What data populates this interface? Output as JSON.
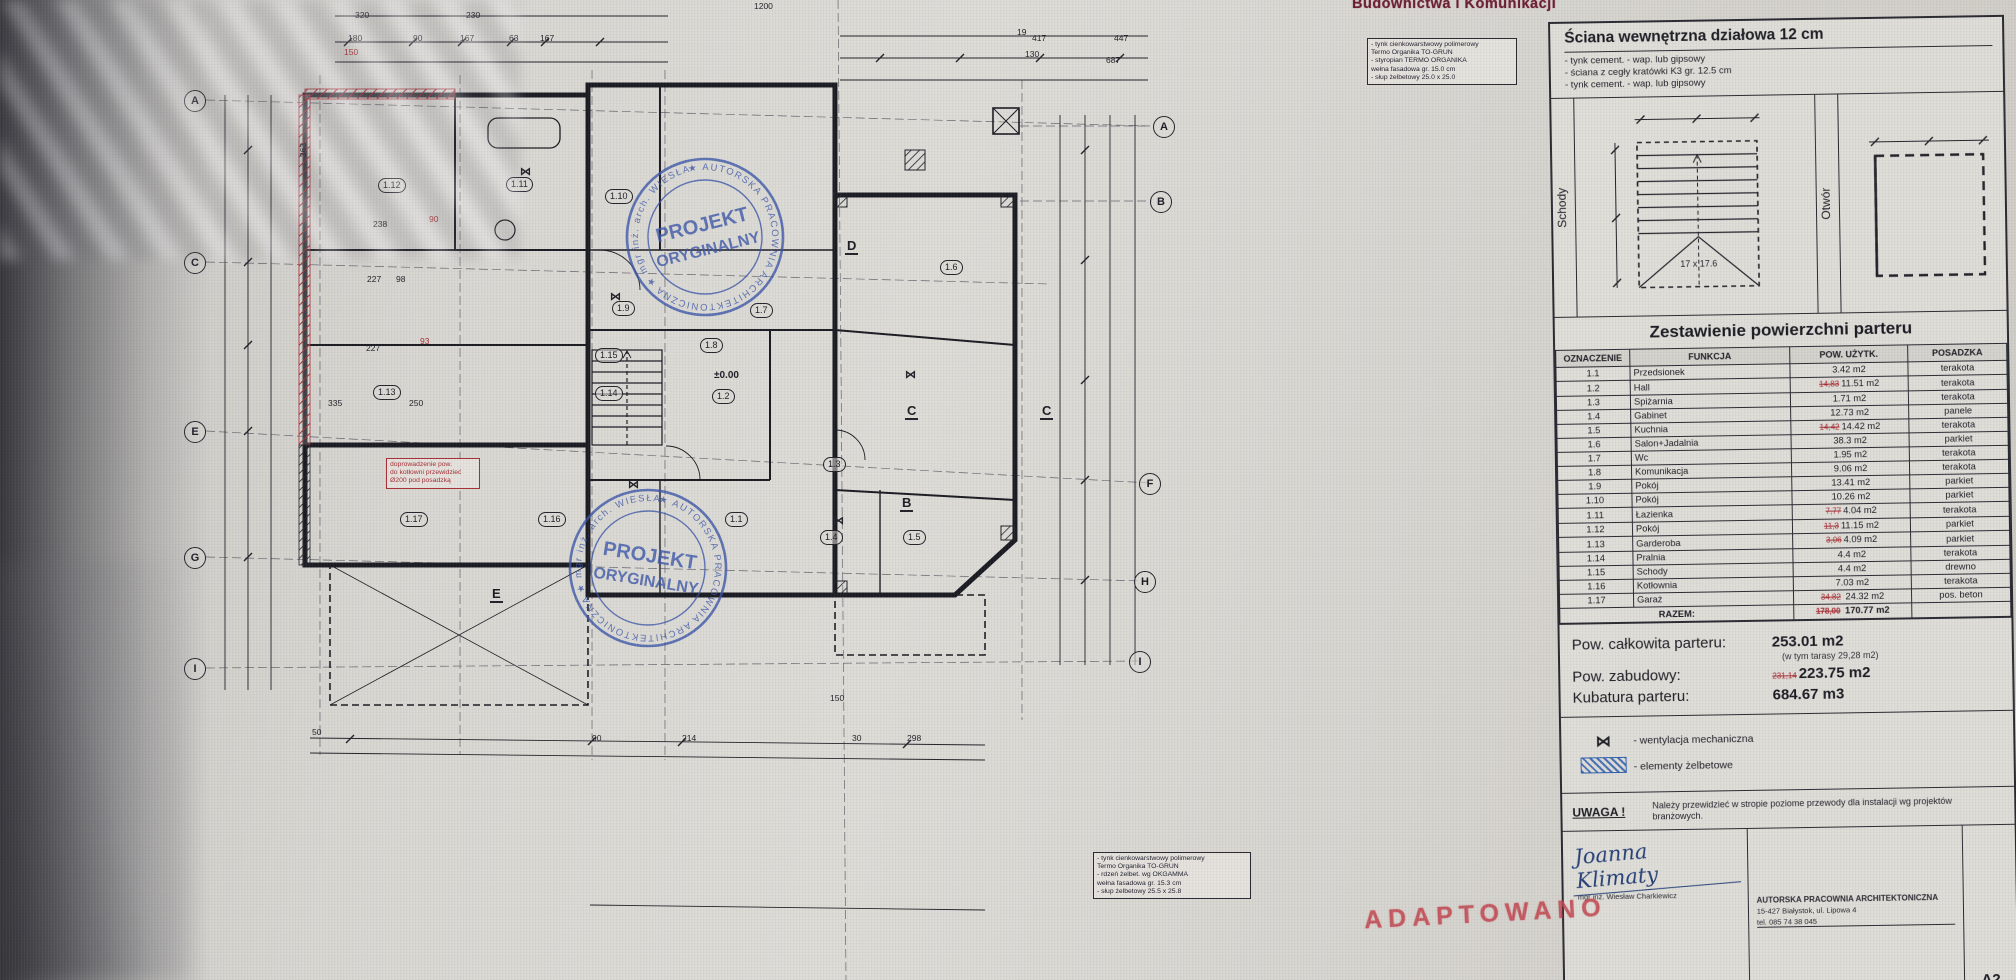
{
  "header_stamp": "Budownictwa i Komunikacji",
  "adaptowano": "ADAPTOWANO",
  "wall_spec": {
    "title": "Ściana wewnętrzna działowa 12 cm",
    "items": [
      "- tynk cement. - wap.  lub gipsowy",
      "- ściana z cegły kratówki K3 gr. 12.5 cm",
      "- tynk cement. - wap.  lub gipsowy"
    ]
  },
  "details": {
    "schody": "Schody",
    "otwor": "Otwór",
    "stairs_note": "17 x 17.6"
  },
  "area_table": {
    "title": "Zestawienie powierzchni parteru",
    "columns": [
      "OZNACZENIE",
      "FUNKCJA",
      "POW. UŻYTK.",
      "POSADZKA"
    ],
    "rows": [
      {
        "ozn": "1.1",
        "funkcja": "Przedsionek",
        "pow": "3.42 m2",
        "posadzka": "terakota"
      },
      {
        "ozn": "1.2",
        "funkcja": "Hall",
        "pow_old": "14,83",
        "pow": "11.51 m2",
        "posadzka": "terakota"
      },
      {
        "ozn": "1.3",
        "funkcja": "Spiżarnia",
        "pow": "1.71 m2",
        "posadzka": "terakota"
      },
      {
        "ozn": "1.4",
        "funkcja": "Gabinet",
        "pow": "12.73 m2",
        "posadzka": "panele"
      },
      {
        "ozn": "1.5",
        "funkcja": "Kuchnia",
        "pow_old": "14,42",
        "pow": "14.42 m2",
        "posadzka": "terakota"
      },
      {
        "ozn": "1.6",
        "funkcja": "Salon+Jadalnia",
        "pow": "38.3 m2",
        "posadzka": "parkiet"
      },
      {
        "ozn": "1.7",
        "funkcja": "Wc",
        "pow": "1.95 m2",
        "posadzka": "terakota"
      },
      {
        "ozn": "1.8",
        "funkcja": "Komunikacja",
        "pow": "9.06 m2",
        "posadzka": "terakota"
      },
      {
        "ozn": "1.9",
        "funkcja": "Pokój",
        "pow": "13.41 m2",
        "posadzka": "parkiet"
      },
      {
        "ozn": "1.10",
        "funkcja": "Pokój",
        "pow": "10.26 m2",
        "posadzka": "parkiet"
      },
      {
        "ozn": "1.11",
        "funkcja": "Łazienka",
        "pow_old": "7,77",
        "pow": "4.04 m2",
        "posadzka": "terakota"
      },
      {
        "ozn": "1.12",
        "funkcja": "Pokój",
        "pow_old": "11,3",
        "pow": "11.15 m2",
        "posadzka": "parkiet"
      },
      {
        "ozn": "1.13",
        "funkcja": "Garderoba",
        "pow_old": "3,06",
        "pow": "4.09 m2",
        "posadzka": "parkiet"
      },
      {
        "ozn": "1.14",
        "funkcja": "Pralnia",
        "pow": "4.4 m2",
        "posadzka": "terakota"
      },
      {
        "ozn": "1.15",
        "funkcja": "Schody",
        "pow": "4.4 m2",
        "posadzka": "drewno"
      },
      {
        "ozn": "1.16",
        "funkcja": "Kotłownia",
        "pow": "7.03 m2",
        "posadzka": "terakota"
      }
    ],
    "garage": {
      "ozn": "1.17",
      "funkcja": "Garaż",
      "pow_old": "34,82",
      "pow": "24.32 m2",
      "posadzka": "pos. beton"
    },
    "razem": {
      "label": "RAZEM:",
      "old": "178,00",
      "value": "170.77 m2"
    }
  },
  "totals": {
    "t1": {
      "label": "Pow. całkowita parteru:",
      "value": "253.01 m2",
      "note": "(w tym tarasy 29,28 m2)"
    },
    "t2": {
      "label": "Pow. zabudowy:",
      "old": "231,14",
      "value": "223.75 m2"
    },
    "t3": {
      "label": "Kubatura parteru:",
      "value": "684.67 m3"
    }
  },
  "legend": {
    "vent_symbol": "⋈",
    "vent_label": "- wentylacja mechaniczna",
    "rc_label": "- elementy żelbetowe"
  },
  "uwaga": {
    "label": "UWAGA !",
    "text": "Należy przewidzieć w stropie poziome przewody dla instalacji wg projektów branżowych."
  },
  "titleblock": {
    "signature": "Joanna Klimaty",
    "signature_sub": "mgr inż. Wiesław Charkiewicz",
    "firm1": "AUTORSKA PRACOWNIA ARCHITEKTONICZNA",
    "firm2": "15-427 Białystok, ul. Lipowa 4",
    "firm3": "tel. 085 74 38 045",
    "sheet": "A2"
  },
  "stamps": {
    "ring": "★ AUTORSKA PRACOWNIA ARCHITEKTONICZNA ★ mgr inż. arch. WIESŁAW CHARKIEWICZ",
    "line1": "PROJEKT",
    "line2": "ORYGINALNY"
  },
  "plan": {
    "level_mark": "±0.00",
    "labels": [
      {
        "kind": "axis",
        "t": "A",
        "x": 184,
        "y": 90
      },
      {
        "kind": "axis",
        "t": "C",
        "x": 184,
        "y": 252
      },
      {
        "kind": "axis",
        "t": "E",
        "x": 184,
        "y": 421
      },
      {
        "kind": "axis",
        "t": "G",
        "x": 184,
        "y": 547
      },
      {
        "kind": "axis",
        "t": "I",
        "x": 184,
        "y": 658
      },
      {
        "kind": "axis",
        "t": "A",
        "x": 1153,
        "y": 116
      },
      {
        "kind": "axis",
        "t": "B",
        "x": 1150,
        "y": 191
      },
      {
        "kind": "axis",
        "t": "F",
        "x": 1139,
        "y": 473
      },
      {
        "kind": "axis",
        "t": "H",
        "x": 1134,
        "y": 571
      },
      {
        "kind": "axis",
        "t": "I",
        "x": 1129,
        "y": 651
      },
      {
        "kind": "room",
        "t": "1.12",
        "x": 378,
        "y": 178
      },
      {
        "kind": "room",
        "t": "1.11",
        "x": 506,
        "y": 177
      },
      {
        "kind": "room",
        "t": "1.10",
        "x": 605,
        "y": 189
      },
      {
        "kind": "room",
        "t": "1.9",
        "x": 612,
        "y": 301
      },
      {
        "kind": "room",
        "t": "1.6",
        "x": 940,
        "y": 260
      },
      {
        "kind": "room",
        "t": "1.7",
        "x": 750,
        "y": 303
      },
      {
        "kind": "room",
        "t": "1.8",
        "x": 700,
        "y": 338
      },
      {
        "kind": "room",
        "t": "1.15",
        "x": 595,
        "y": 348
      },
      {
        "kind": "room",
        "t": "1.14",
        "x": 595,
        "y": 386
      },
      {
        "kind": "room",
        "t": "1.13",
        "x": 373,
        "y": 385
      },
      {
        "kind": "room",
        "t": "1.2",
        "x": 712,
        "y": 389
      },
      {
        "kind": "room",
        "t": "1.3",
        "x": 823,
        "y": 457
      },
      {
        "kind": "room",
        "t": "1.17",
        "x": 400,
        "y": 512
      },
      {
        "kind": "room",
        "t": "1.16",
        "x": 538,
        "y": 512
      },
      {
        "kind": "room",
        "t": "1.1",
        "x": 725,
        "y": 512
      },
      {
        "kind": "room",
        "t": "1.4",
        "x": 820,
        "y": 530
      },
      {
        "kind": "room",
        "t": "1.5",
        "x": 903,
        "y": 530
      },
      {
        "kind": "vent",
        "t": "⋈",
        "x": 520,
        "y": 165
      },
      {
        "kind": "vent",
        "t": "⋈",
        "x": 610,
        "y": 290
      },
      {
        "kind": "vent",
        "t": "⋈",
        "x": 905,
        "y": 368
      },
      {
        "kind": "vent",
        "t": "⋈",
        "x": 833,
        "y": 514
      },
      {
        "kind": "vent",
        "t": "⋈",
        "x": 628,
        "y": 478
      },
      {
        "kind": "level",
        "t": "±0.00",
        "x": 714,
        "y": 370
      },
      {
        "kind": "sect",
        "t": "D",
        "x": 845,
        "y": 238
      },
      {
        "kind": "sect",
        "t": "C",
        "x": 905,
        "y": 403
      },
      {
        "kind": "sect",
        "t": "C",
        "x": 1040,
        "y": 403
      },
      {
        "kind": "sect",
        "t": "B",
        "x": 900,
        "y": 495
      },
      {
        "kind": "sect",
        "t": "E",
        "x": 490,
        "y": 586
      },
      {
        "kind": "dim",
        "t": "320",
        "x": 355,
        "y": 10
      },
      {
        "kind": "dim",
        "t": "230",
        "x": 466,
        "y": 10
      },
      {
        "kind": "dim",
        "t": "1200",
        "x": 754,
        "y": 1
      },
      {
        "kind": "dim",
        "t": "180",
        "x": 348,
        "y": 33
      },
      {
        "kind": "dim",
        "t": "90",
        "x": 413,
        "y": 33
      },
      {
        "kind": "dim",
        "t": "167",
        "x": 460,
        "y": 33
      },
      {
        "kind": "dim",
        "t": "63",
        "x": 509,
        "y": 33
      },
      {
        "kind": "dim",
        "t": "167",
        "x": 540,
        "y": 33
      },
      {
        "kind": "dimr",
        "t": "150",
        "x": 344,
        "y": 47
      },
      {
        "kind": "dim",
        "t": "19",
        "x": 1017,
        "y": 27
      },
      {
        "kind": "dim",
        "t": "417",
        "x": 1032,
        "y": 33
      },
      {
        "kind": "dim",
        "t": "447",
        "x": 1114,
        "y": 33
      },
      {
        "kind": "dim",
        "t": "130",
        "x": 1025,
        "y": 49
      },
      {
        "kind": "dim",
        "t": "687",
        "x": 1106,
        "y": 55
      },
      {
        "kind": "dim",
        "t": "363",
        "x": 296,
        "y": 145,
        "rot": -90
      },
      {
        "kind": "dim",
        "t": "238",
        "x": 373,
        "y": 219
      },
      {
        "kind": "dimr",
        "t": "90",
        "x": 429,
        "y": 214
      },
      {
        "kind": "dim",
        "t": "227",
        "x": 367,
        "y": 274
      },
      {
        "kind": "dim",
        "t": "98",
        "x": 396,
        "y": 274
      },
      {
        "kind": "dimr",
        "t": "93",
        "x": 420,
        "y": 336
      },
      {
        "kind": "dim",
        "t": "227",
        "x": 366,
        "y": 343
      },
      {
        "kind": "dim",
        "t": "335",
        "x": 328,
        "y": 398
      },
      {
        "kind": "dim",
        "t": "250",
        "x": 409,
        "y": 398
      },
      {
        "kind": "dim",
        "t": "50",
        "x": 312,
        "y": 727
      },
      {
        "kind": "dim",
        "t": "90",
        "x": 592,
        "y": 733
      },
      {
        "kind": "dim",
        "t": "214",
        "x": 682,
        "y": 733
      },
      {
        "kind": "dim",
        "t": "150",
        "x": 830,
        "y": 693
      },
      {
        "kind": "dim",
        "t": "30",
        "x": 852,
        "y": 733
      },
      {
        "kind": "dim",
        "t": "298",
        "x": 907,
        "y": 733
      }
    ],
    "notes": [
      {
        "x": 1367,
        "y": 38,
        "w": 142,
        "c": "blue",
        "lines": [
          "- tynk cienkowarstwowy polimerowy",
          "  Termo Organika TO-GRUN",
          "- styropian TERMO ORGANIKA",
          "  wełna fasadowa gr. 15.0 cm",
          "- słup żelbetowy 25.0 x 25.0"
        ]
      },
      {
        "x": 1093,
        "y": 852,
        "w": 150,
        "c": "blue",
        "lines": [
          "- tynk cienkowarstwowy polimerowy",
          "  Termo Organika TO-GRUN",
          "- rdzeń żelbet. wg OKGAMMA",
          "  wełna fasadowa gr. 15.3 cm",
          "- słup żelbetowy 25.5 x 25.8"
        ]
      },
      {
        "x": 386,
        "y": 458,
        "w": 86,
        "c": "red",
        "lines": [
          "doprowadzenie pow.",
          "do kotłowni przewidzieć",
          "Ø200 pod posadzką"
        ]
      }
    ]
  }
}
